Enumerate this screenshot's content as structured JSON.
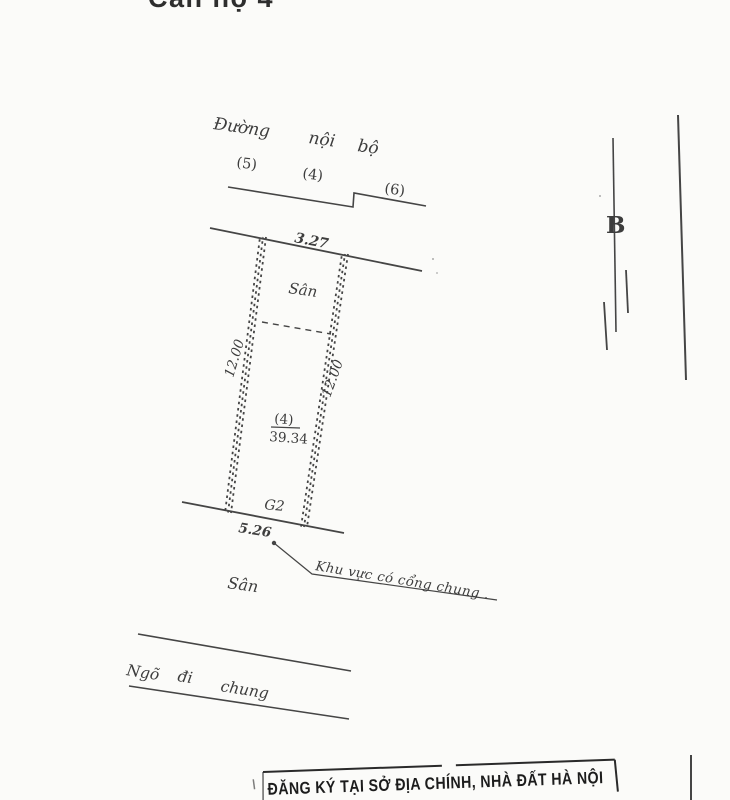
{
  "colors": {
    "paper": "#fbfbf9",
    "ink": "#3d3d3d",
    "stamp_ink": "#1c1c1c"
  },
  "header": {
    "title": "Căn hộ 4"
  },
  "site_plan": {
    "road": {
      "name_word1": "Đường",
      "name_word2": "nội",
      "name_word3": "bộ"
    },
    "adjacent_parcels": {
      "left": "(5)",
      "middle": "(4)",
      "right": "(6)"
    },
    "dimensions": {
      "top_width": "3.27",
      "left_depth": "12.00",
      "right_depth": "12.00",
      "bottom_width": "5.26"
    },
    "parcel": {
      "id": "(4)",
      "area": "39.34"
    },
    "labels": {
      "yard_top": "Sân",
      "gate": "G2",
      "yard_bottom": "Sân",
      "shared_gate_note": "Khu vực có cổng chung .",
      "alley_word1": "Ngõ",
      "alley_word2": "đi",
      "alley_word3": "chung",
      "marker_b": "B"
    }
  },
  "stamp": {
    "text": "ĐĂNG KÝ TẠI SỞ ĐỊA CHÍNH, NHÀ ĐẤT HÀ NỘI"
  }
}
